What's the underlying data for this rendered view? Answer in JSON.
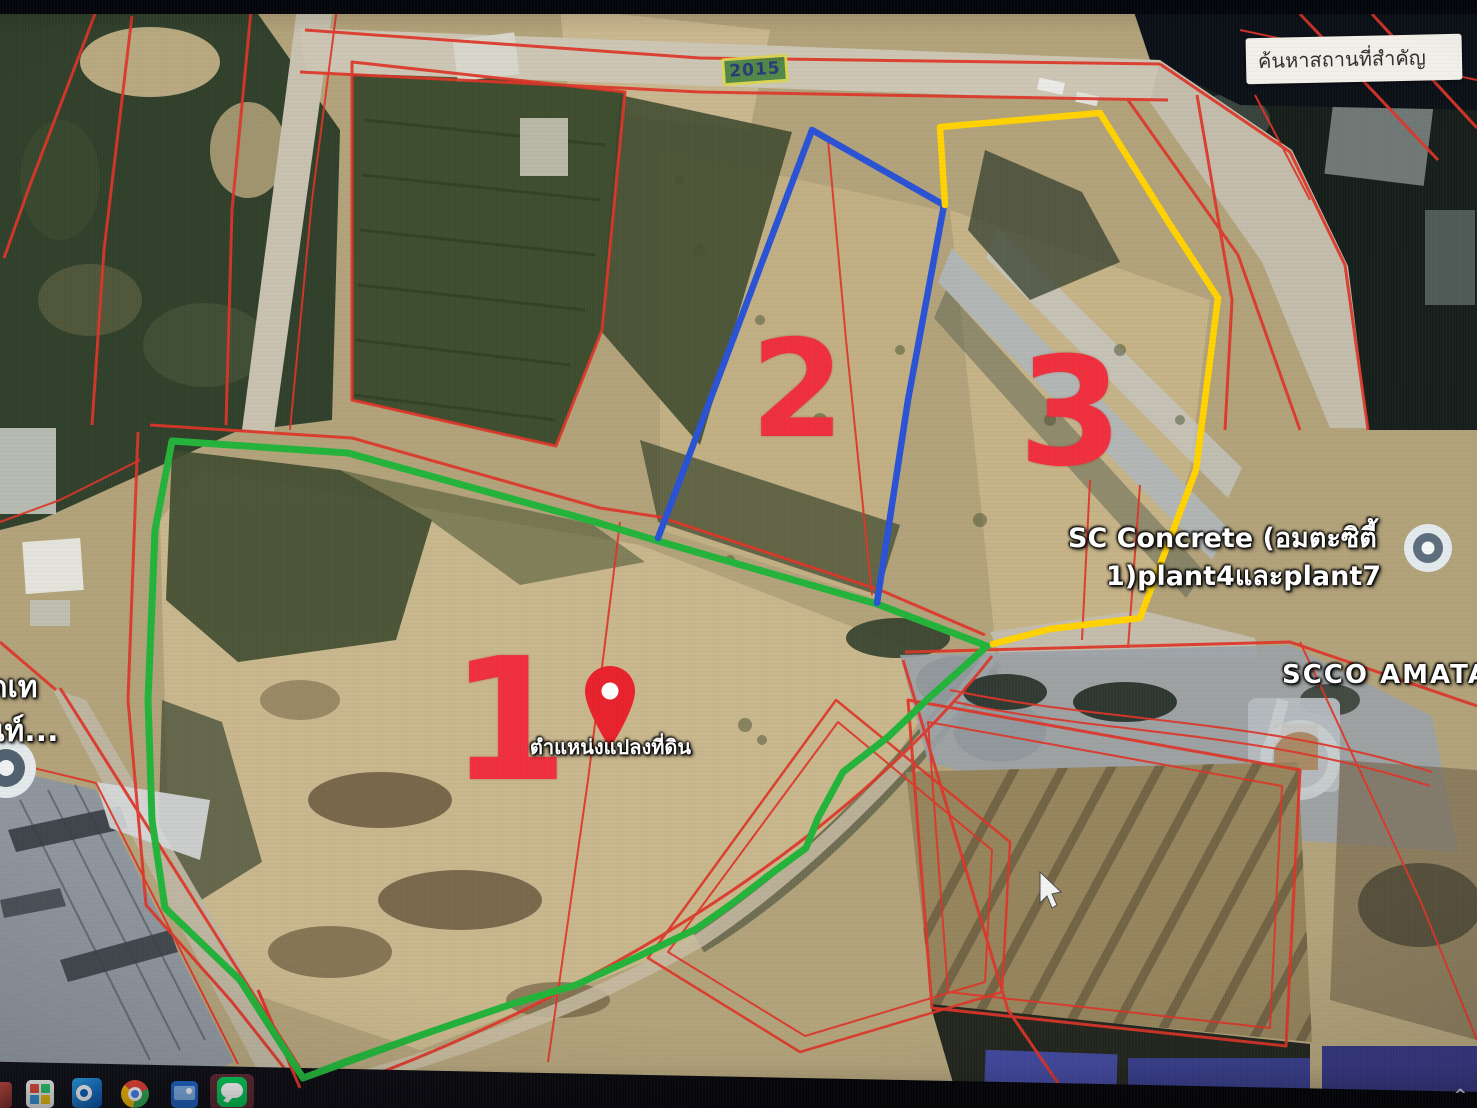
{
  "search": {
    "text": "ค้นหาสถานที่สำคัญ"
  },
  "road_badge": {
    "number": "2015"
  },
  "parcels": [
    {
      "number": "1",
      "outline_color": "#23b33a"
    },
    {
      "number": "2",
      "outline_color": "#2a52d4"
    },
    {
      "number": "3",
      "outline_color": "#ffd200"
    }
  ],
  "pin": {
    "label": "ตำแหน่งแปลงที่ดิน"
  },
  "map_labels": {
    "sc_concrete_line1": "SC Concrete (อมตะซิตี้",
    "sc_concrete_line2": "1)plant4และplant7",
    "scco_amata": "SCCO AMATAC",
    "left_edge_line1": "ดเท",
    "left_edge_line2": "นท์..."
  },
  "colors": {
    "cadastral_line": "#dd3528",
    "parcel_number": "#ef2f3d"
  },
  "taskbar": {
    "icons": [
      "edge-partial",
      "store",
      "outlook",
      "chrome",
      "photos",
      "line"
    ],
    "chevron": "^"
  }
}
